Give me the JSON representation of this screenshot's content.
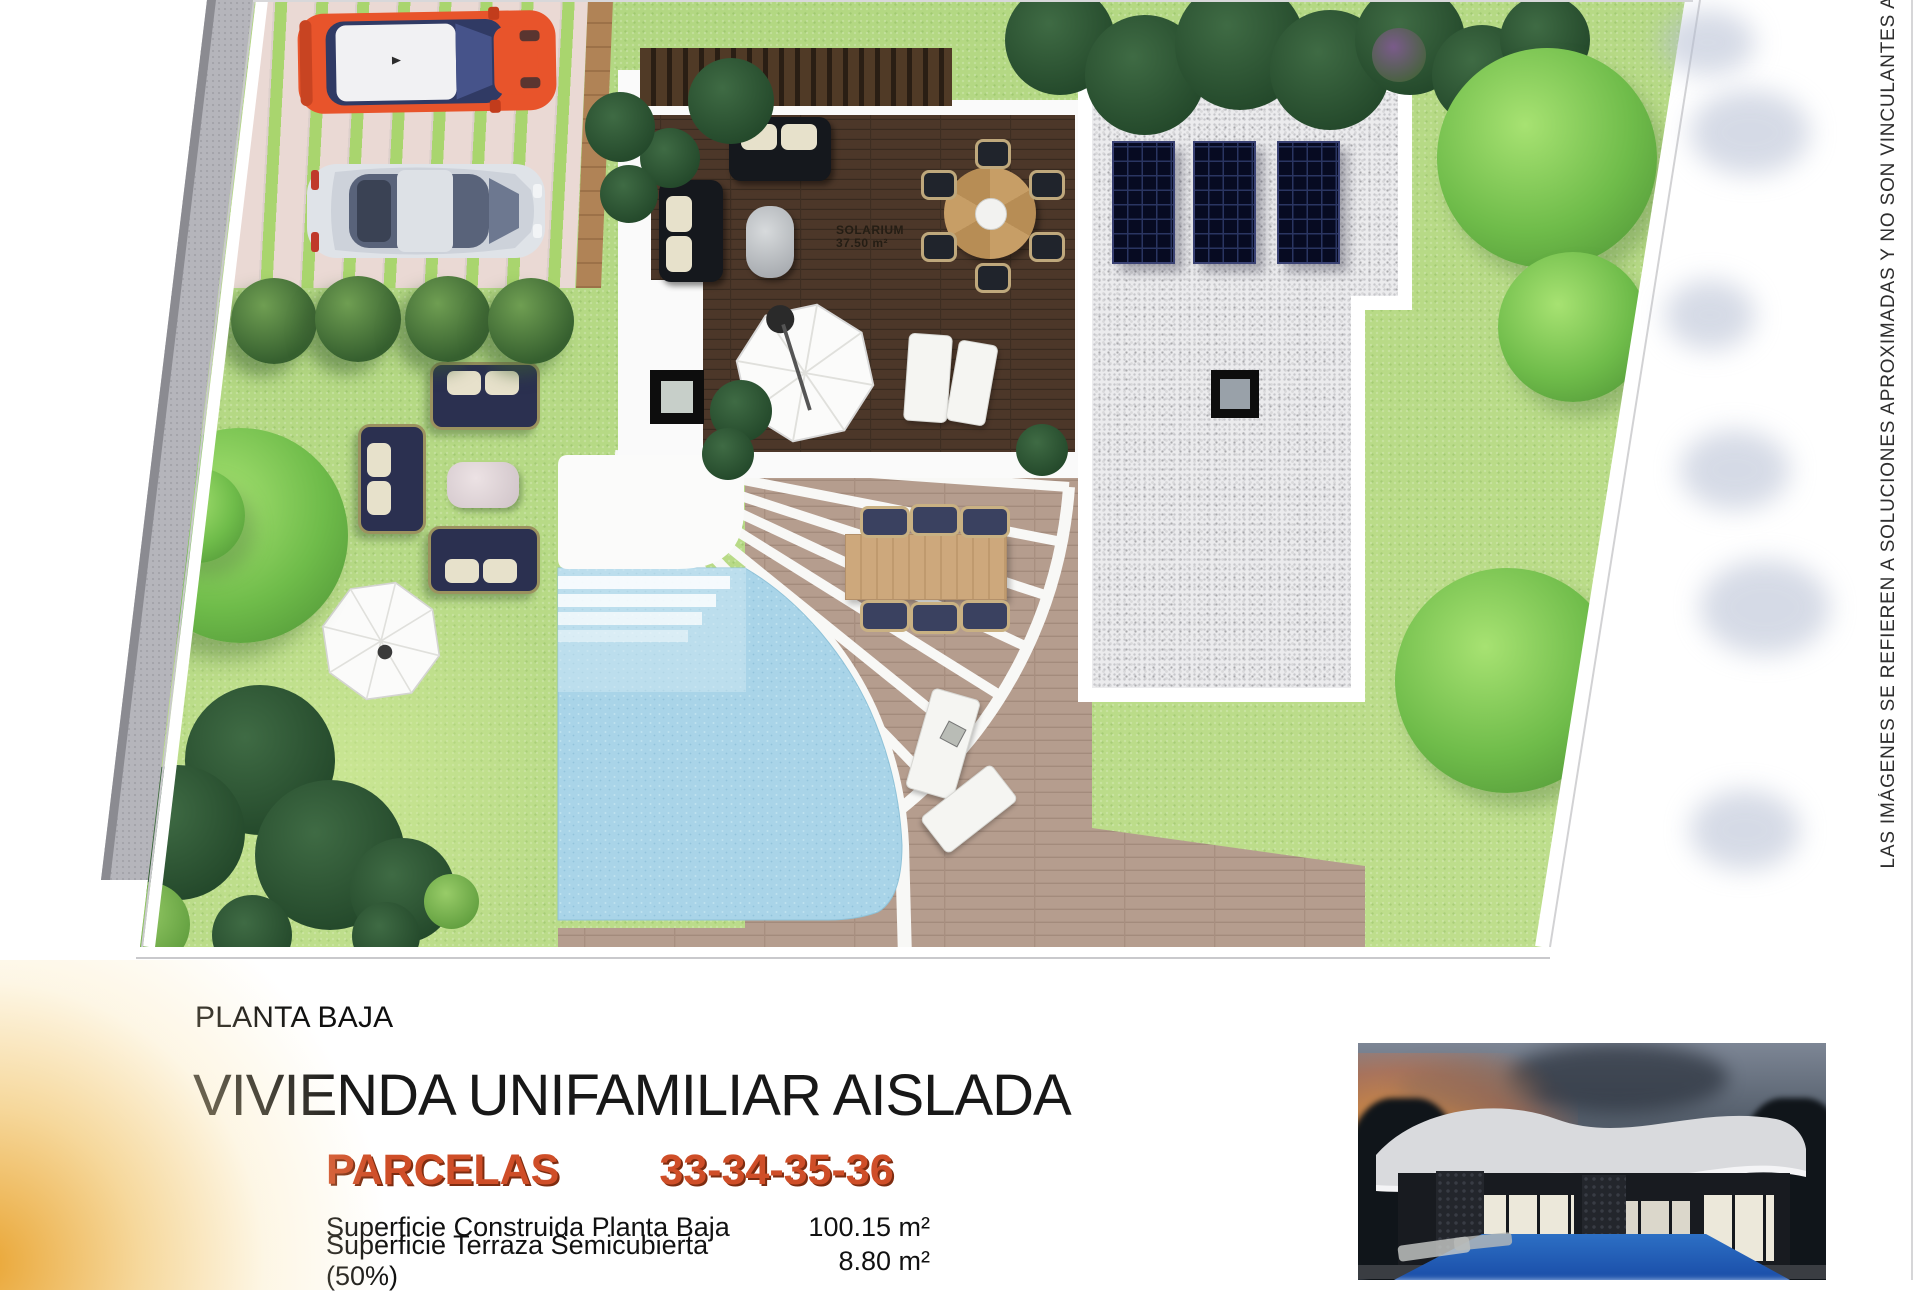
{
  "plan": {
    "solarium_label": "SOLARIUM",
    "solarium_area": "37.50 m²"
  },
  "disclaimer": {
    "text": "LAS IMÁGENES SE REFIEREN A SOLUCIONES APROXIMADAS Y NO SON VINCULANTES AL PROYECTO"
  },
  "footer": {
    "floor_label": "PLANTA BAJA",
    "title": "VIVIENDA UNIFAMILIAR AISLADA",
    "parcels_label": "PARCELAS",
    "parcels_numbers": "33-34-35-36",
    "areas": [
      {
        "label": "Superficie Construida Planta Baja",
        "value": "100.15 m²"
      },
      {
        "label": "Superficie Terraza Semicubierta (50%)",
        "value": "8.80 m²"
      }
    ]
  },
  "colors": {
    "grass": "#b4d985",
    "deck_wood": "#4c3729",
    "terrace_wood": "#b59d8e",
    "pool_water": "#a9d4e8",
    "gravel_roof": "#ebebed",
    "solar_panel": "#070b22",
    "parcels_accent": "#cf4e28",
    "car_orange": "#e8542b",
    "car_silver": "#dfe3e8",
    "sun_glow": "#e8a028"
  }
}
